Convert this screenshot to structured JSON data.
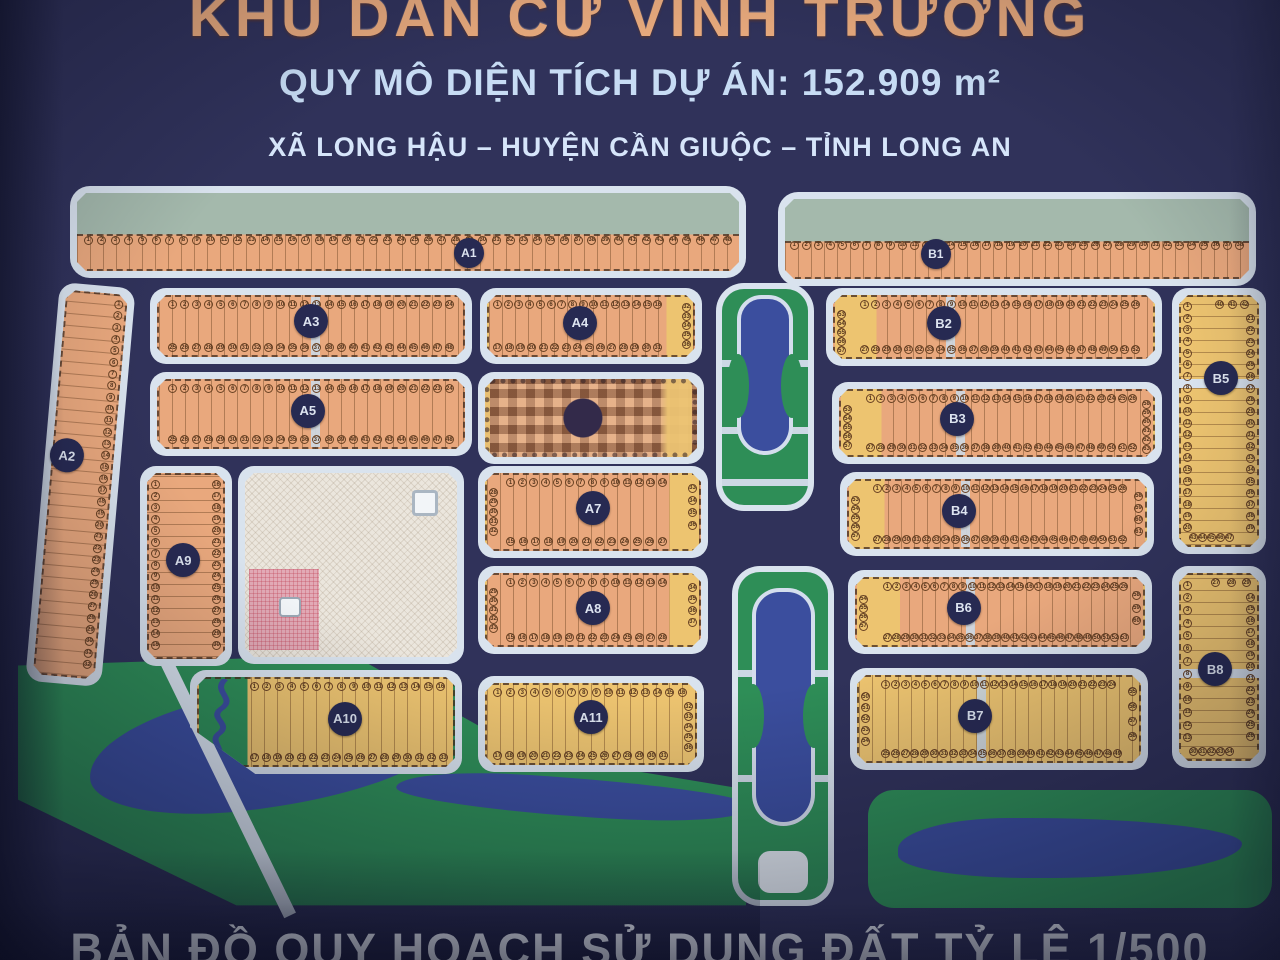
{
  "header": {
    "title": "KHU DÂN CƯ VĨNH TRƯỜNG",
    "area_line": "QUY MÔ DIỆN TÍCH DỰ ÁN: 152.909 m²",
    "location_line": "XÃ LONG HẬU – HUYỆN CẦN GIUỘC – TỈNH LONG AN"
  },
  "footer": {
    "caption": "BẢN ĐỒ QUY HOẠCH SỬ DỤNG ĐẤT TỶ LỆ 1/500"
  },
  "colors": {
    "bg": "#30325a",
    "road": "#d9e3ee",
    "lot_orange": "#e9a87d",
    "lot_yellow": "#edc470",
    "green": "#2e8e57",
    "green_gray": "#a4b9ac",
    "water": "#3b4e9e",
    "label": "#272a52",
    "cream": "#ebe6dd",
    "pink": "#e2aab6",
    "line": "rgba(101,61,29,0.42)",
    "censor_base": "#cf9067",
    "censor_dark": "#332a4a"
  },
  "blocks": [
    {
      "id": "A1",
      "label": "A1",
      "kind": "strip",
      "x": 70,
      "y": 186,
      "w": 676,
      "h": 92,
      "green_top": 53,
      "lp": [
        59,
        73
      ],
      "rows": [
        {
          "side": "mid",
          "count": 48,
          "at": 55,
          "inset": [
            1,
            1
          ]
        }
      ]
    },
    {
      "id": "B1",
      "label": "B1",
      "kind": "strip",
      "x": 778,
      "y": 192,
      "w": 478,
      "h": 94,
      "green_top": 53,
      "lp": [
        33,
        66
      ],
      "rows": [
        {
          "side": "mid",
          "count": 38,
          "at": 52,
          "inset": [
            1,
            1
          ]
        }
      ]
    },
    {
      "id": "A2",
      "label": "A2",
      "kind": "v",
      "x": 60,
      "y": 282,
      "w": 76,
      "h": 400,
      "rot": 5,
      "fill": "orange",
      "lp": [
        29,
        43
      ],
      "rows": [
        {
          "side": "right",
          "count": 32,
          "inset": [
            1,
            2
          ]
        }
      ]
    },
    {
      "id": "A3",
      "label": "A3",
      "kind": "h",
      "x": 150,
      "y": 288,
      "w": 322,
      "h": 76,
      "fill": "orange",
      "alley": 50,
      "lp": [
        50,
        44
      ],
      "rows": [
        {
          "side": "top",
          "count": 24,
          "inset": [
            3,
            3
          ]
        },
        {
          "side": "bottom",
          "count": 24,
          "inset": [
            3,
            3
          ]
        }
      ]
    },
    {
      "id": "A4",
      "label": "A4",
      "kind": "h",
      "x": 480,
      "y": 288,
      "w": 222,
      "h": 76,
      "fill": "orange",
      "endR": 13,
      "lp": [
        45,
        46
      ],
      "rows": [
        {
          "side": "top",
          "count": 16,
          "inset": [
            2,
            15
          ]
        },
        {
          "side": "bottom",
          "count": 15,
          "inset": [
            2,
            15
          ]
        },
        {
          "side": "right",
          "count": 5,
          "inset": [
            10,
            10
          ]
        }
      ]
    },
    {
      "id": "A5",
      "label": "A5",
      "kind": "h",
      "x": 150,
      "y": 372,
      "w": 322,
      "h": 84,
      "fill": "orange",
      "alley": 50,
      "lp": [
        49,
        46
      ],
      "rows": [
        {
          "side": "top",
          "count": 24,
          "inset": [
            3,
            3
          ]
        },
        {
          "side": "bottom",
          "count": 24,
          "inset": [
            3,
            3
          ]
        }
      ]
    },
    {
      "id": "A6",
      "label": "",
      "kind": "censored",
      "x": 478,
      "y": 372,
      "w": 226,
      "h": 92
    },
    {
      "id": "B2",
      "label": "B2",
      "kind": "h",
      "x": 826,
      "y": 288,
      "w": 336,
      "h": 78,
      "fill": "orange",
      "endL": 13,
      "alley": 35,
      "lp": [
        35,
        45
      ],
      "rows": [
        {
          "side": "top",
          "count": 26,
          "inset": [
            8,
            4
          ]
        },
        {
          "side": "bottom",
          "count": 26,
          "inset": [
            8,
            4
          ]
        },
        {
          "side": "left",
          "count": 5,
          "inset": [
            22,
            22
          ]
        }
      ]
    },
    {
      "id": "B3",
      "label": "B3",
      "kind": "h",
      "x": 832,
      "y": 382,
      "w": 330,
      "h": 82,
      "fill": "orange",
      "endL": 13,
      "alley": 37,
      "lp": [
        38,
        45
      ],
      "rows": [
        {
          "side": "top",
          "count": 26,
          "inset": [
            8,
            5
          ]
        },
        {
          "side": "bottom",
          "count": 26,
          "inset": [
            8,
            5
          ]
        },
        {
          "side": "left",
          "count": 5,
          "inset": [
            22,
            22
          ]
        },
        {
          "side": "right",
          "count": 6,
          "inset": [
            14,
            14
          ]
        }
      ]
    },
    {
      "id": "B5",
      "label": "B5",
      "kind": "v",
      "x": 1172,
      "y": 288,
      "w": 94,
      "h": 266,
      "fill": "yellow",
      "cross": 33,
      "lp": [
        52,
        34
      ],
      "rows": [
        {
          "side": "left",
          "count": 20,
          "inset": [
            2,
            5
          ]
        },
        {
          "side": "right",
          "count": 19,
          "inset": [
            7,
            5
          ]
        },
        {
          "side": "top",
          "count": 3,
          "inset": [
            45,
            10
          ]
        },
        {
          "side": "bottom",
          "count": 5,
          "inset": [
            10,
            35
          ]
        }
      ]
    },
    {
      "id": "A9",
      "label": "A9",
      "kind": "v",
      "x": 140,
      "y": 466,
      "w": 92,
      "h": 200,
      "fill": "orange",
      "lp": [
        47,
        47
      ],
      "rows": [
        {
          "side": "left",
          "count": 15,
          "inset": [
            3,
            4
          ]
        },
        {
          "side": "right",
          "count": 15,
          "inset": [
            3,
            4
          ]
        }
      ]
    },
    {
      "id": "PUBLIC",
      "label": "",
      "kind": "school",
      "x": 238,
      "y": 466,
      "w": 226,
      "h": 198
    },
    {
      "id": "A7",
      "label": "A7",
      "kind": "h",
      "x": 478,
      "y": 466,
      "w": 230,
      "h": 92,
      "fill": "orange",
      "endR": 14,
      "lp": [
        50,
        46
      ],
      "rows": [
        {
          "side": "top",
          "count": 14,
          "inset": [
            9,
            15
          ]
        },
        {
          "side": "bottom",
          "count": 13,
          "inset": [
            9,
            15
          ]
        },
        {
          "side": "left",
          "count": 5,
          "inset": [
            18,
            18
          ]
        },
        {
          "side": "right",
          "count": 4,
          "inset": [
            12,
            26
          ]
        }
      ]
    },
    {
      "id": "B4",
      "label": "B4",
      "kind": "h",
      "x": 840,
      "y": 472,
      "w": 314,
      "h": 84,
      "fill": "orange",
      "endL": 12,
      "alley": 38,
      "lp": [
        38,
        46
      ],
      "rows": [
        {
          "side": "top",
          "count": 26,
          "inset": [
            8,
            6
          ]
        },
        {
          "side": "bottom",
          "count": 26,
          "inset": [
            8,
            6
          ]
        },
        {
          "side": "left",
          "count": 5,
          "inset": [
            22,
            22
          ]
        },
        {
          "side": "right",
          "count": 4,
          "inset": [
            16,
            16
          ]
        }
      ]
    },
    {
      "id": "A8",
      "label": "A8",
      "kind": "h",
      "x": 478,
      "y": 566,
      "w": 230,
      "h": 88,
      "fill": "orange",
      "endR": 14,
      "lp": [
        50,
        48
      ],
      "rows": [
        {
          "side": "top",
          "count": 14,
          "inset": [
            9,
            15
          ]
        },
        {
          "side": "bottom",
          "count": 14,
          "inset": [
            9,
            15
          ]
        },
        {
          "side": "left",
          "count": 5,
          "inset": [
            18,
            18
          ]
        },
        {
          "side": "right",
          "count": 4,
          "inset": [
            12,
            26
          ]
        }
      ]
    },
    {
      "id": "B6",
      "label": "B6",
      "kind": "h",
      "x": 848,
      "y": 570,
      "w": 304,
      "h": 84,
      "fill": "orange",
      "endL": 15,
      "alley": 38,
      "lp": [
        38,
        45
      ],
      "rows": [
        {
          "side": "top",
          "count": 26,
          "inset": [
            9,
            5
          ]
        },
        {
          "side": "bottom",
          "count": 27,
          "inset": [
            9,
            5
          ]
        },
        {
          "side": "left",
          "count": 4,
          "inset": [
            24,
            24
          ]
        },
        {
          "side": "right",
          "count": 3,
          "inset": [
            18,
            30
          ]
        }
      ]
    },
    {
      "id": "B8",
      "label": "B8",
      "kind": "v",
      "x": 1172,
      "y": 566,
      "w": 94,
      "h": 202,
      "fill": "yellow",
      "cross": 51,
      "lp": [
        46,
        51
      ],
      "rows": [
        {
          "side": "left",
          "count": 13,
          "inset": [
            3,
            9
          ]
        },
        {
          "side": "right",
          "count": 13,
          "inset": [
            10,
            10
          ]
        },
        {
          "side": "top",
          "count": 3,
          "inset": [
            40,
            8
          ]
        },
        {
          "side": "bottom",
          "count": 5,
          "inset": [
            10,
            35
          ]
        }
      ]
    },
    {
      "id": "A10",
      "label": "A10",
      "kind": "h",
      "x": 190,
      "y": 670,
      "w": 272,
      "h": 104,
      "fill": "yellow",
      "green_left": 19,
      "clip": "polygon(0% 0%, 100% 0%, 100% 100%, 24% 100%, 0% 55%)",
      "lp": [
        57,
        47
      ],
      "rows": [
        {
          "side": "top",
          "count": 16,
          "inset": [
            20,
            3
          ]
        },
        {
          "side": "bottom",
          "count": 17,
          "inset": [
            20,
            2
          ]
        }
      ]
    },
    {
      "id": "A11",
      "label": "A11",
      "kind": "h",
      "x": 478,
      "y": 676,
      "w": 226,
      "h": 96,
      "fill": "yellow",
      "lp": [
        50,
        43
      ],
      "rows": [
        {
          "side": "top",
          "count": 16,
          "inset": [
            3,
            4
          ]
        },
        {
          "side": "bottom",
          "count": 15,
          "inset": [
            3,
            13
          ]
        },
        {
          "side": "right",
          "count": 5,
          "inset": [
            22,
            14
          ]
        }
      ]
    },
    {
      "id": "B7",
      "label": "B7",
      "kind": "h",
      "x": 850,
      "y": 668,
      "w": 298,
      "h": 102,
      "fill": "yellow",
      "alley": 42,
      "lp": [
        42,
        47
      ],
      "rows": [
        {
          "side": "top",
          "count": 24,
          "inset": [
            8,
            8
          ]
        },
        {
          "side": "bottom",
          "count": 25,
          "inset": [
            8,
            6
          ]
        },
        {
          "side": "left",
          "count": 5,
          "inset": [
            18,
            18
          ]
        },
        {
          "side": "right",
          "count": 4,
          "inset": [
            12,
            24
          ]
        }
      ]
    }
  ],
  "features": [
    {
      "kind": "park",
      "x": 18,
      "y": 650,
      "w": 728,
      "h": 258,
      "clip": "polygon(0% 6%, 46% 2%, 70% 40%, 100% 54%, 100% 99%, 30% 99%, 0% 58%)",
      "lake": {
        "x": 70,
        "y": 40,
        "w": 360,
        "h": 118
      },
      "river": {
        "x": 378,
        "y": 128,
        "w": 352,
        "h": 38,
        "rot": 4
      }
    },
    {
      "kind": "diagroad",
      "x": 160,
      "y": 662,
      "w": 13,
      "h": 282,
      "rot": -26
    },
    {
      "kind": "canal",
      "x": 716,
      "y": 283,
      "w": 98,
      "h": 228,
      "paths": [
        33,
        64,
        88
      ],
      "water": {
        "top": 3,
        "h": 70,
        "side": 17
      },
      "bite": 30
    },
    {
      "kind": "canal",
      "x": 732,
      "y": 566,
      "w": 102,
      "h": 340,
      "paths": [
        30,
        62
      ],
      "water": {
        "top": 5,
        "h": 70,
        "side": 15
      },
      "bite": 34,
      "cup": true
    },
    {
      "kind": "greenstrip",
      "x": 868,
      "y": 790,
      "w": 404,
      "h": 118,
      "river": {
        "x": 30,
        "y": 28,
        "w": 344,
        "h": 60
      }
    }
  ]
}
